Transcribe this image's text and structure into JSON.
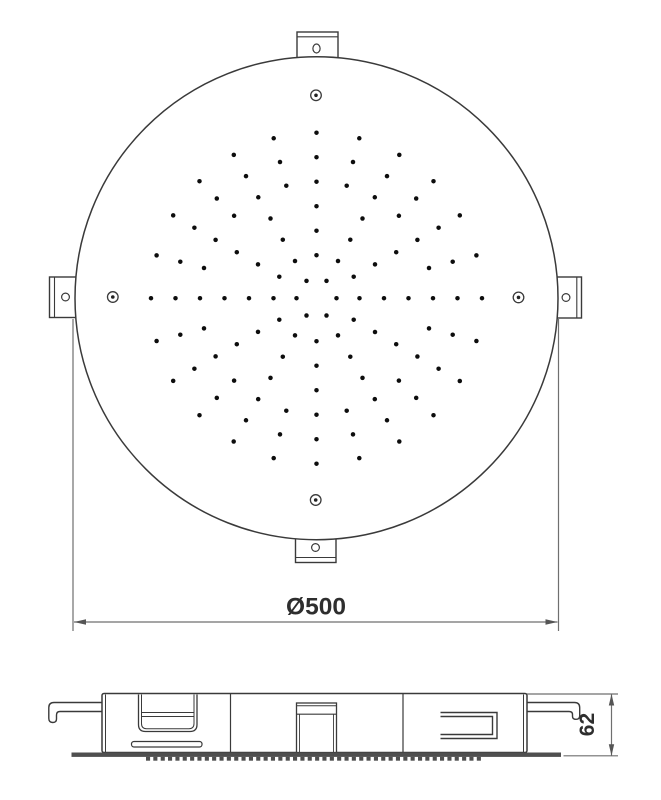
{
  "drawing": {
    "kind": "technical-drawing-shower-head",
    "dimensions": {
      "diameter_label": "Ø500",
      "height_label": "62"
    },
    "colors": {
      "line": "#3a3a3a",
      "dim": "#6f6f6f",
      "dot": "#0d0d0d",
      "text": "#2e2e2e",
      "plate": "#4f4f4f",
      "background": "#ffffff"
    },
    "nozzle_pattern": {
      "center_x": 316.5,
      "center_y": 298.2,
      "dot_radius": 2.25,
      "rings": [
        {
          "r": 20,
          "step_deg": 60,
          "start_deg": 0
        },
        {
          "r": 43,
          "step_deg": 30,
          "start_deg": 0
        },
        {
          "r": 67.5,
          "step_deg": 30,
          "start_deg": 0
        },
        {
          "r": 92,
          "step_deg": 30,
          "start_deg": 0
        },
        {
          "r": 116.5,
          "step_deg": 15,
          "start_deg": 0
        },
        {
          "r": 141,
          "step_deg": 15,
          "start_deg": 0
        },
        {
          "r": 165.5,
          "step_deg": 15,
          "start_deg": 0
        }
      ]
    },
    "side_view": {
      "teeth": {
        "x_start": 146,
        "x_end": 483,
        "step": 7.35,
        "width": 4.1,
        "height": 3.9,
        "y": 756.8
      }
    }
  }
}
